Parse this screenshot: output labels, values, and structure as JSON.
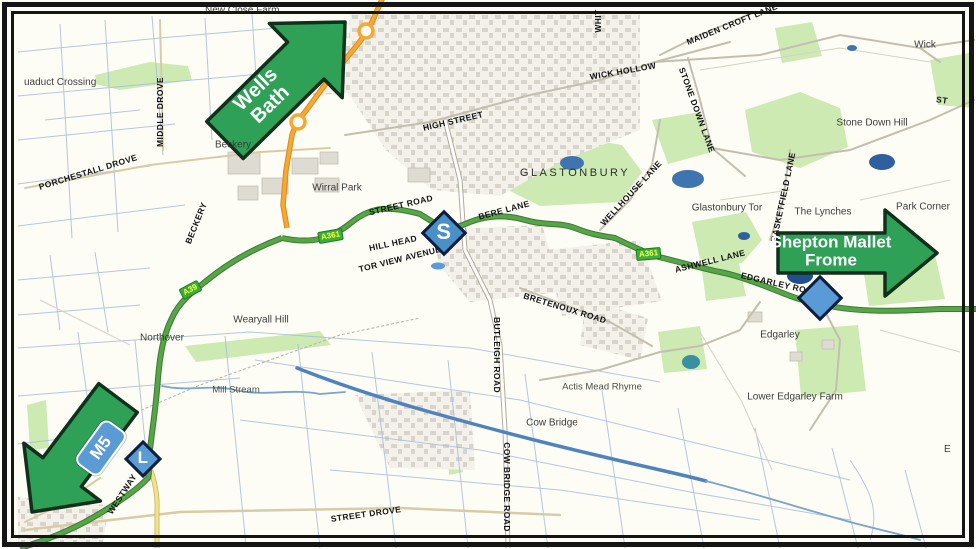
{
  "map": {
    "title": "Annotated road map of the Glastonbury area",
    "arrows": {
      "wells_bath": {
        "line1": "Wells",
        "line2": "Bath",
        "direction": "northeast"
      },
      "shepton_frome": {
        "line1": "Shepton Mallet",
        "line2": "Frome",
        "direction": "east"
      },
      "m5": {
        "badge": "M5",
        "direction": "southwest"
      }
    },
    "markers": {
      "s": {
        "letter": "S"
      },
      "l": {
        "letter": "L"
      },
      "plain": {
        "letter": ""
      }
    },
    "road_badges": {
      "a361_west": "A361",
      "a361_east": "A361",
      "a39": "A39"
    },
    "labels": {
      "new_close_farm": "New Close Farm",
      "aquaduct_crossing": "uaduct Crossing",
      "middle_drove": "MIDDLE DROVE",
      "porchestall_drove": "PORCHESTALL DROVE",
      "beckery_town": "Beckery",
      "beckery_road": "BECKERY",
      "wirral_park": "Wirral Park",
      "high_street": "HIGH STREET",
      "wick_hollow": "WICK HOLLOW",
      "whit_partial": "WHIT",
      "maiden_croft_lane": "MAIDEN CROFT LANE",
      "stone_down_lane": "STONE DOWN LANE",
      "wick": "Wick",
      "stone_down_hill": "Stone Down Hill",
      "st_partial": "ST",
      "glastonbury": "GLASTONBURY",
      "street_road": "STREET ROAD",
      "hill_head": "HILL HEAD",
      "tor_view_avenue": "TOR VIEW AVENUE",
      "bere_lane": "BERE LANE",
      "wellhouse_lane": "WELLHOUSE LANE",
      "glastonbury_tor": "Glastonbury Tor",
      "basketfield_lane": "BASKETFIELD LANE",
      "the_lynches": "The Lynches",
      "park_corner": "Park Corner",
      "ashwell_lane": "ASHWELL LANE",
      "edgarley_road": "EDGARLEY ROAD",
      "bretenoux_road": "BRETENOUX ROAD",
      "wearyall_hill": "Wearyall Hill",
      "northover": "Northover",
      "butleigh_road": "BUTLEIGH ROAD",
      "edgarley": "Edgarley",
      "actis_mead_rhyme": "Actis Mead Rhyme",
      "lower_edgarley_farm": "Lower Edgarley Farm",
      "mill_stream": "Mill Stream",
      "cow_bridge": "Cow Bridge",
      "cow_bridge_road": "COW BRIDGE ROAD",
      "street_drove": "STREET DROVE",
      "westway": "WESTWAY",
      "e_partial": "E"
    },
    "colors": {
      "arrow_green": "#2ea157",
      "arrow_border": "#10301c",
      "marker_blue": "#4a90c8",
      "marker_blue_light": "#5b9bd5",
      "marker_border": "#0f1e3c",
      "road_green": "#56a546",
      "road_orange": "#f6a832",
      "road_yellow": "#f3e287",
      "badge_green": "#3cae3c",
      "badge_text": "#ffff4d",
      "water_blue": "#4f83bd",
      "ditch_blue": "#a6bedd",
      "woodland_green": "#cdeab3",
      "urban_grey": "#d8d4cb"
    }
  }
}
